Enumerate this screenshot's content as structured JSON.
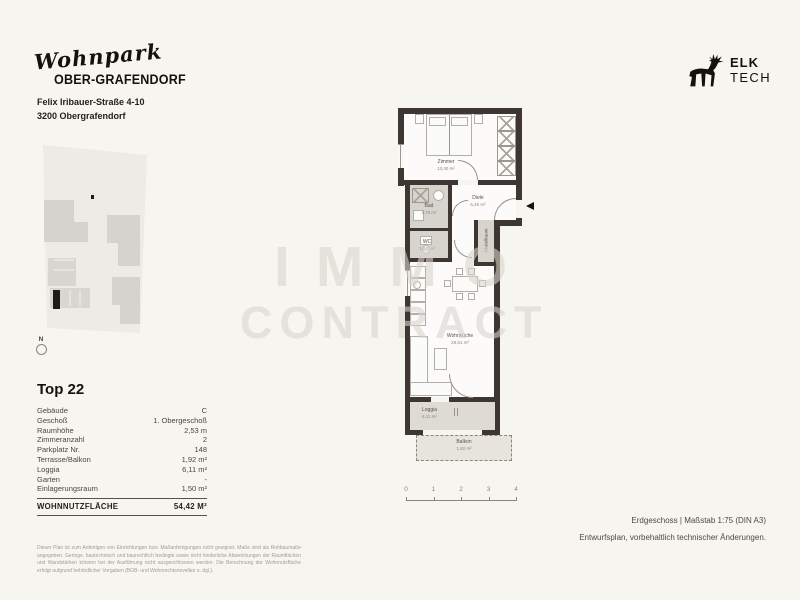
{
  "header": {
    "brand_script": "Wohnpark",
    "brand_name": "OBER-GRAFENDORF",
    "address_line1": "Felix Iribauer-Straße 4-10",
    "address_line2": "3200 Obergrafendorf",
    "logo_line1": "ELK",
    "logo_line2": "TECH"
  },
  "site_plan": {
    "compass_label": "N"
  },
  "unit": {
    "title": "Top 22",
    "rows": [
      {
        "label": "Gebäude",
        "value": "C"
      },
      {
        "label": "Geschoß",
        "value": "1. Obergeschoß"
      },
      {
        "label": "Raumhöhe",
        "value": "2,53 m"
      },
      {
        "label": "Zimmeranzahl",
        "value": "2"
      },
      {
        "label": "Parkplatz Nr.",
        "value": "148"
      },
      {
        "label": "Terrasse/Balkon",
        "value": "1,92 m²"
      },
      {
        "label": "Loggia",
        "value": "6,11 m²"
      },
      {
        "label": "Garten",
        "value": "-"
      },
      {
        "label": "Einlagerungsraum",
        "value": "1,50 m²"
      }
    ],
    "total_label": "Wohnnutzfläche",
    "total_value": "54,42 m²"
  },
  "watermark": {
    "line1": "IMMO",
    "line2": "CONTRACT"
  },
  "floor_plan": {
    "rooms": [
      {
        "name": "Zimmer",
        "area": "13,40 m²"
      },
      {
        "name": "Diele",
        "area": "6,45 m²"
      },
      {
        "name": "Bad",
        "area": "3,70 m²"
      },
      {
        "name": "WC",
        "area": "1,63 m²"
      },
      {
        "name": "Abstellraum",
        "area": "1,45 m²"
      },
      {
        "name": "Wohnküche",
        "area": "28,51 m²"
      },
      {
        "name": "Loggia",
        "area": "6,11 m²"
      },
      {
        "name": "Balkon",
        "area": "1,92 m²"
      }
    ],
    "scale_ticks": [
      "0",
      "1",
      "2",
      "3",
      "4"
    ]
  },
  "footer": {
    "plan_info": "Erdgeschoss | Maßstab 1:75 (DIN A3)",
    "note": "Entwurfsplan, vorbehaltlich technischer Änderungen.",
    "disclaimer": "Dieser Plan ist zum Anfertigen von Einrichtungen bzw. Maßanfertigungen nicht geeignet. Maße sind als Rohbaumaße angegeben. Geringe, bautechnisch und baurechtlich bedingte sowie nicht hinderliche Abweichungen der Raumflächen und Wandstärken können bei der Ausführung nicht ausgeschlossen werden. Die Berechnung der Wohnnutzfläche erfolgt aufgrund behördlicher Vorgaben (BGB- und Wohnrechtsnovellen o. dgl.)."
  }
}
